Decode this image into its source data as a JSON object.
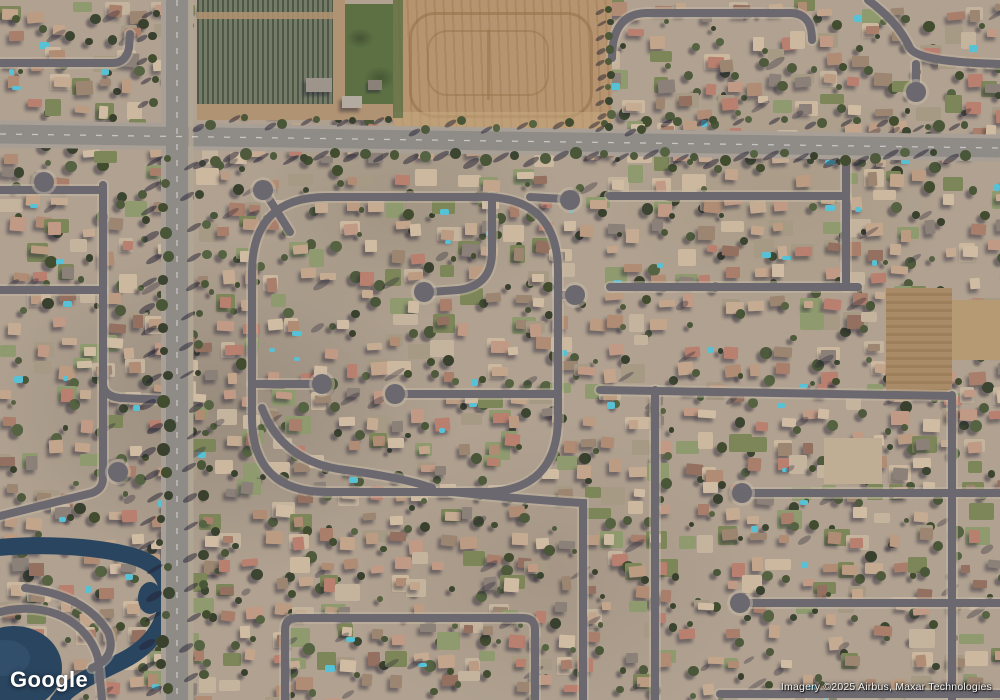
{
  "map": {
    "view_type": "satellite",
    "watermark_logo": "Google",
    "attribution": "Imagery ©2025 Airbus, Maxar Technologies",
    "colors": {
      "terrain": "#b0a190",
      "road_residential": "#6b6870",
      "road_casing": "#c6b9a5",
      "road_arterial": "#8f8b87",
      "road_arterial_edge": "#a8a096",
      "road_shoulder": "#b3a893",
      "lane_marking": "#ffffff",
      "dirt_field": "#b5946f",
      "dirt_dark": "#96754f",
      "dirt_band": "#c4a77e",
      "vineyard_dark": "#4f5747",
      "vineyard_light": "#747c68",
      "vineyard_dirt": "#b09372",
      "green_patch": "#5c7044",
      "water": "#2a4560",
      "water_light": "#3a587a",
      "pool": "#57c2d6",
      "shadow": "rgba(38,36,54,0.45)",
      "roofs": [
        "#c5ab92",
        "#bb9c82",
        "#a97e6a",
        "#93705f",
        "#d0bba3",
        "#8b8178",
        "#b08c74",
        "#c2a58b",
        "#9c8672",
        "#b97f6f",
        "#c09a85"
      ],
      "trees": [
        "#3c4531",
        "#4a5638",
        "#566342",
        "#39412e",
        "#4f5a3d",
        "#424d30"
      ],
      "pads": [
        "#c4b49e",
        "#7d8659",
        "#a79a85",
        "#cbb89f",
        "#8f9a6f"
      ]
    }
  }
}
